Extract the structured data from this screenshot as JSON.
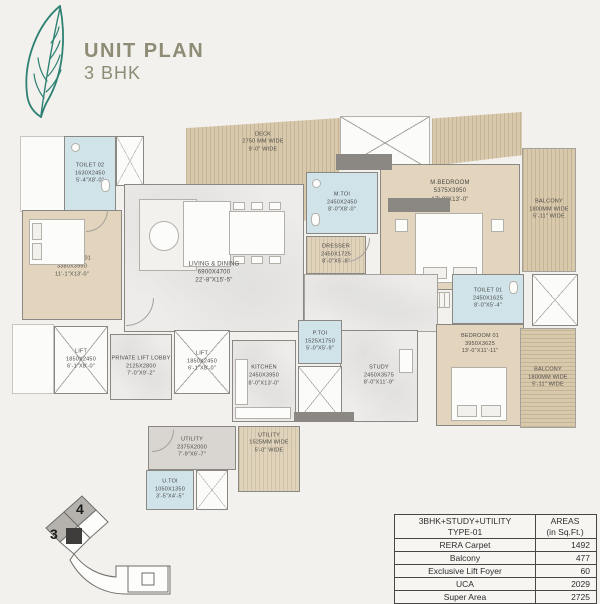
{
  "header": {
    "title": "UNIT PLAN",
    "subtitle": "3 BHK"
  },
  "rooms": {
    "toilet02": {
      "name": "TOILET 02",
      "mm": "1630X2450",
      "ft": "5'-4\"X8'-0\""
    },
    "bedroom01_left": {
      "name": "BEDROOM 01",
      "mm": "3380X3950",
      "ft": "11'-1\"X13'-0\""
    },
    "deck": {
      "name": "DECK",
      "mm": "2750 MM WIDE",
      "ft": "9'-0\" WIDE"
    },
    "mtoi": {
      "name": "M.TOI",
      "mm": "2450X2450",
      "ft": "8'-0\"X8'-0\""
    },
    "mbedroom": {
      "name": "M.BEDROOM",
      "mm": "5375X3950",
      "ft": "17'-8\"X13'-0\""
    },
    "balcony_tr": {
      "name": "BALCONY",
      "mm": "1800MM WIDE",
      "ft": "5'-11\" WIDE"
    },
    "dresser": {
      "name": "DRESSER",
      "mm": "2450X1725",
      "ft": "8'-0\"X5'-8\""
    },
    "living": {
      "name": "LIVING & DINING",
      "mm": "6900X4700",
      "ft": "22'-8\"X15'-5\""
    },
    "toilet01": {
      "name": "TOILET 01",
      "mm": "2450X1625",
      "ft": "8'-0\"X5'-4\""
    },
    "bedroom01_right": {
      "name": "BEDROOM 01",
      "mm": "3950X3625",
      "ft": "13'-0\"X11'-11\""
    },
    "balcony_br": {
      "name": "BALCONY",
      "mm": "1800MM WIDE",
      "ft": "5'-11\" WIDE"
    },
    "lift_left": {
      "name": "LIFT",
      "mm": "1850X2450",
      "ft": "6'-1\"X8'-0\""
    },
    "pll": {
      "name": "PRIVATE LIFT LOBBY",
      "mm": "2125X2800",
      "ft": "7'-0\"X9'-2\""
    },
    "lift_c": {
      "name": "LIFT",
      "mm": "1850X2450",
      "ft": "6'-1\"X8'-0\""
    },
    "kitchen": {
      "name": "KITCHEN",
      "mm": "2450X3950",
      "ft": "8'-0\"X13'-0\""
    },
    "ptoi": {
      "name": "P.TOI",
      "mm": "1525X1750",
      "ft": "5'-0\"X5'-9\""
    },
    "study": {
      "name": "STUDY",
      "mm": "2450X3575",
      "ft": "8'-0\"X11'-9\""
    },
    "utility1": {
      "name": "UTILITY",
      "mm": "2375X2000",
      "ft": "7'-9\"X6'-7\""
    },
    "utility2": {
      "name": "UTILITY",
      "mm": "1525MM WIDE",
      "ft": "5'-0\" WIDE"
    },
    "utoi": {
      "name": "U.TOI",
      "mm": "1050X1350",
      "ft": "3'-5\"X4'-5\""
    }
  },
  "keyplan": {
    "unit3": "3",
    "unit4": "4"
  },
  "areas_table": {
    "col1_line1": "3BHK+STUDY+UTILITY",
    "col1_line2": "TYPE-01",
    "col2_line1": "AREAS",
    "col2_line2": "(in Sq.Ft.)",
    "rows": [
      {
        "label": "RERA Carpet",
        "value": "1492"
      },
      {
        "label": "Balcony",
        "value": "477"
      },
      {
        "label": "Exclusive Lift Foyer",
        "value": "60"
      },
      {
        "label": "UCA",
        "value": "2029"
      },
      {
        "label": "Super Area",
        "value": "2725"
      }
    ]
  }
}
